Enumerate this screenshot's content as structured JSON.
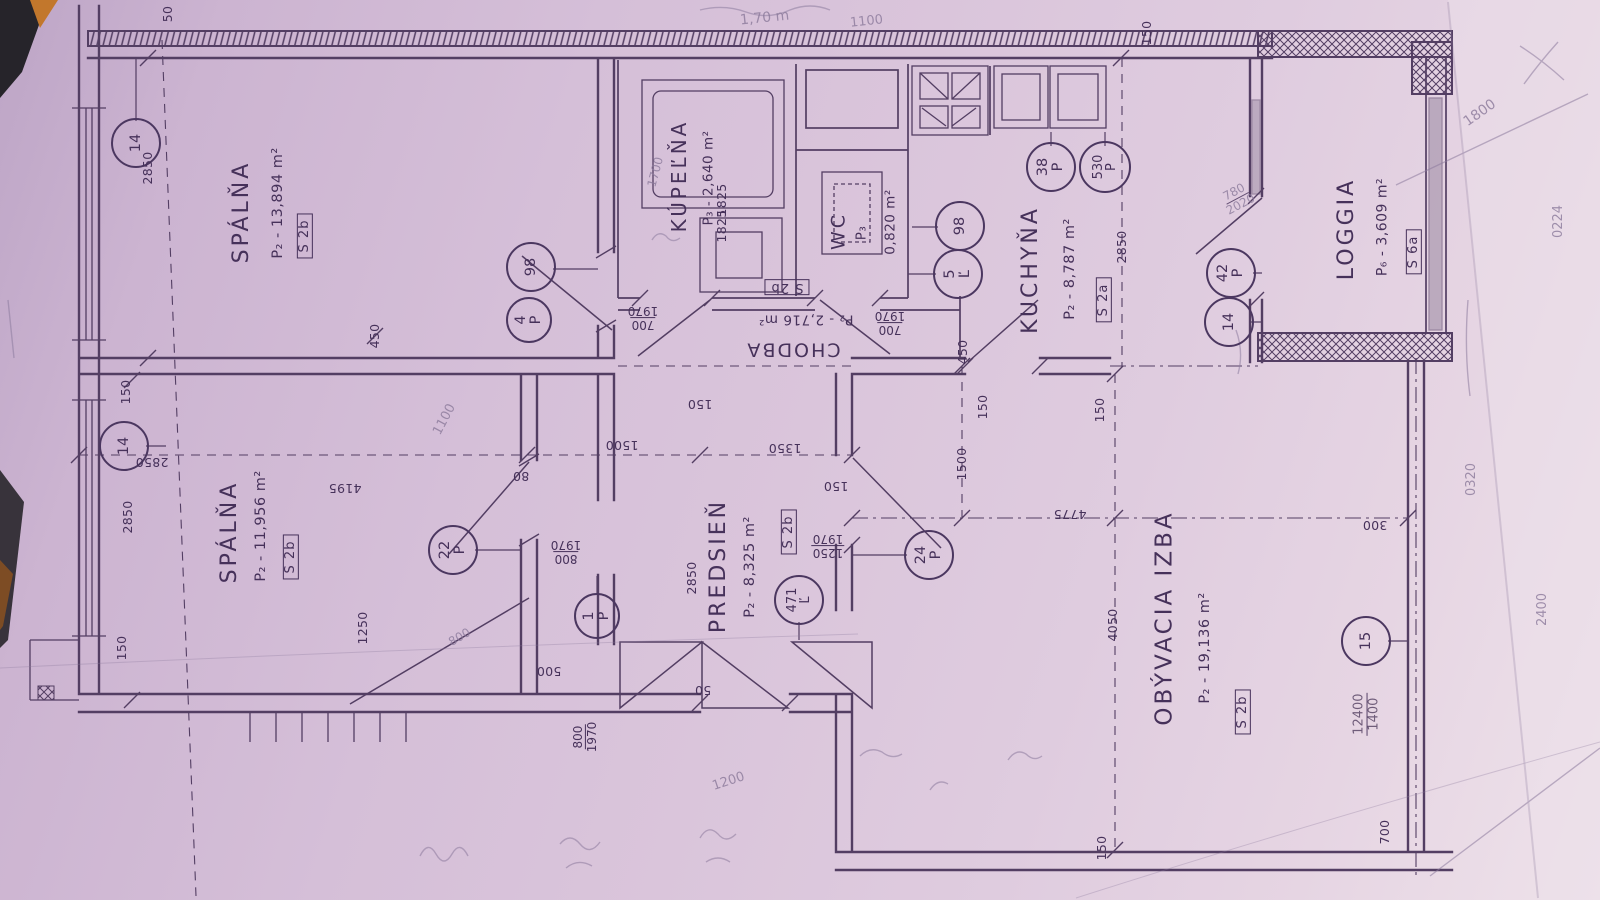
{
  "plan": {
    "rooms": {
      "spalna1": {
        "name": "SPÁLŇA",
        "area": "P₂ - 13,894 m²",
        "tag": "S 2b"
      },
      "spalna2": {
        "name": "SPÁLŇA",
        "area": "P₂ - 11,956 m²",
        "tag": "S 2b"
      },
      "kupelna": {
        "name": "KÚPEĽŇA",
        "area": "P₃ - 2,640 m²",
        "dim": "1825"
      },
      "wc": {
        "name": "WC",
        "p": "P₃",
        "area": "0,820 m²"
      },
      "chodba": {
        "name": "CHODBA",
        "area": "P₂ - 2,716 m²",
        "tag": "S 2b"
      },
      "kuchyna": {
        "name": "KUCHYŇA",
        "area": "P₂ - 8,787 m²",
        "tag": "S 2a",
        "dim": "2850"
      },
      "predsien": {
        "name": "PREDSIEŇ",
        "area": "P₂ - 8,325 m²",
        "tag": "S 2b"
      },
      "obyvacia": {
        "name": "OBÝVACIA IZBA",
        "area": "P₂ - 19,136 m²",
        "tag": "S 2b"
      },
      "loggia": {
        "name": "LOGGIA",
        "area": "P₆ - 3,609 m²",
        "tag": "S 6a"
      }
    },
    "markers": {
      "m14a": "14",
      "m14b": "14",
      "m98a": "98",
      "m4n": "4",
      "m4l": "P",
      "m98b": "98",
      "m5n": "5",
      "m5l": "Ľ",
      "m38n": "38",
      "m38l": "P",
      "m530n": "530",
      "m530l": "P",
      "m42n": "42",
      "m42l": "P",
      "m14c": "14",
      "m22n": "22",
      "m22l": "P",
      "m1n": "1",
      "m1l": "P",
      "m471n": "471",
      "m471l": "Ľ",
      "m24n": "24",
      "m24l": "P",
      "m15": "15"
    },
    "dims": {
      "d50_top": "50",
      "d150_loggia": "150",
      "d2850_tl": "2850",
      "d450_s1": "450",
      "d150_w1": "150",
      "d2850_w": "2850",
      "d150_w2": "150",
      "d2850_s2": "2850",
      "d4195": "4195",
      "d1250": "1250",
      "d1500_pr": "1500",
      "d1350": "1350",
      "d150_ch": "150",
      "d150_pr": "150",
      "d80": "80",
      "d2850_pr": "2850",
      "d500": "500",
      "d50_pr": "50",
      "d800_a": "800",
      "d1970_a": "1970",
      "d800_b": "800",
      "d1970_b": "1970",
      "d1250_c": "1250",
      "d1970_c": "1970",
      "d700_d": "700",
      "d1970_d": "1970",
      "d700_e": "700",
      "d1970_e": "1970",
      "d1825": "1825",
      "d2850_k": "2850",
      "d450_k": "450",
      "d150_k": "150",
      "d1500_k": "1500",
      "d150_k2": "150",
      "d4775": "4775",
      "d4050": "4050",
      "d300": "300",
      "d700_r": "700",
      "d150_b": "150"
    },
    "pencil": {
      "a170": "1,70 m",
      "a1100": "1100",
      "b1100": "1100",
      "a1800": "1800",
      "a780": "780",
      "a2020": "2020",
      "a12400": "12400",
      "a1400": "1400",
      "a1200": "1200",
      "a0320": "0320",
      "a0224": "0224",
      "a2400": "2400",
      "a800": "800",
      "a1700": "1700"
    }
  }
}
